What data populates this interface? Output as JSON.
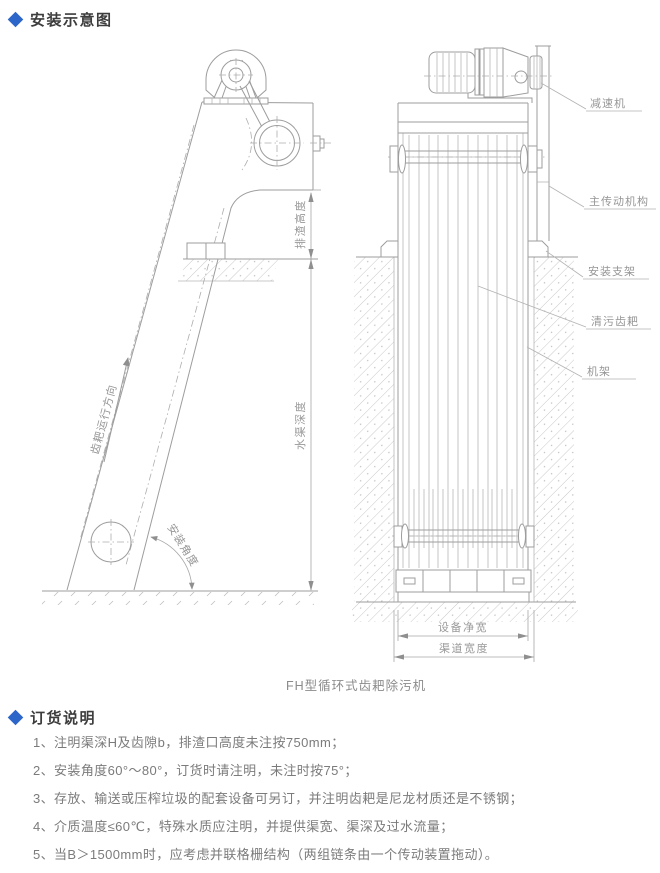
{
  "colors": {
    "accent": "#2d66c9"
  },
  "install_section": {
    "title": "安装示意图"
  },
  "diagram": {
    "caption": "FH型循环式齿耙除污机",
    "callouts": {
      "reducer": "减速机",
      "main_drive": "主传动机构",
      "mount_bracket": "安装支架",
      "cleaning_rake": "清污齿耙",
      "frame": "机架"
    },
    "dimensions": {
      "discharge_height": "排渣高度",
      "channel_depth": "水渠深度",
      "equipment_net_width": "设备净宽",
      "channel_width": "渠道宽度"
    },
    "annotations": {
      "rake_direction": "齿耙运行方向",
      "install_angle": "安装角度"
    }
  },
  "ordering_section": {
    "title": "订货说明",
    "items": [
      "1、注明渠深H及齿隙b，排渣口高度未注按750mm；",
      "2、安装角度60°～80°，订货时请注明，未注时按75°；",
      "3、存放、输送或压榨垃圾的配套设备可另订，并注明齿耙是尼龙材质还是不锈钢；",
      "4、介质温度≤60℃，特殊水质应注明，并提供渠宽、渠深及过水流量；",
      "5、当B＞1500mm时，应考虑并联格栅结构（两组链条由一个传动装置拖动）。"
    ]
  }
}
